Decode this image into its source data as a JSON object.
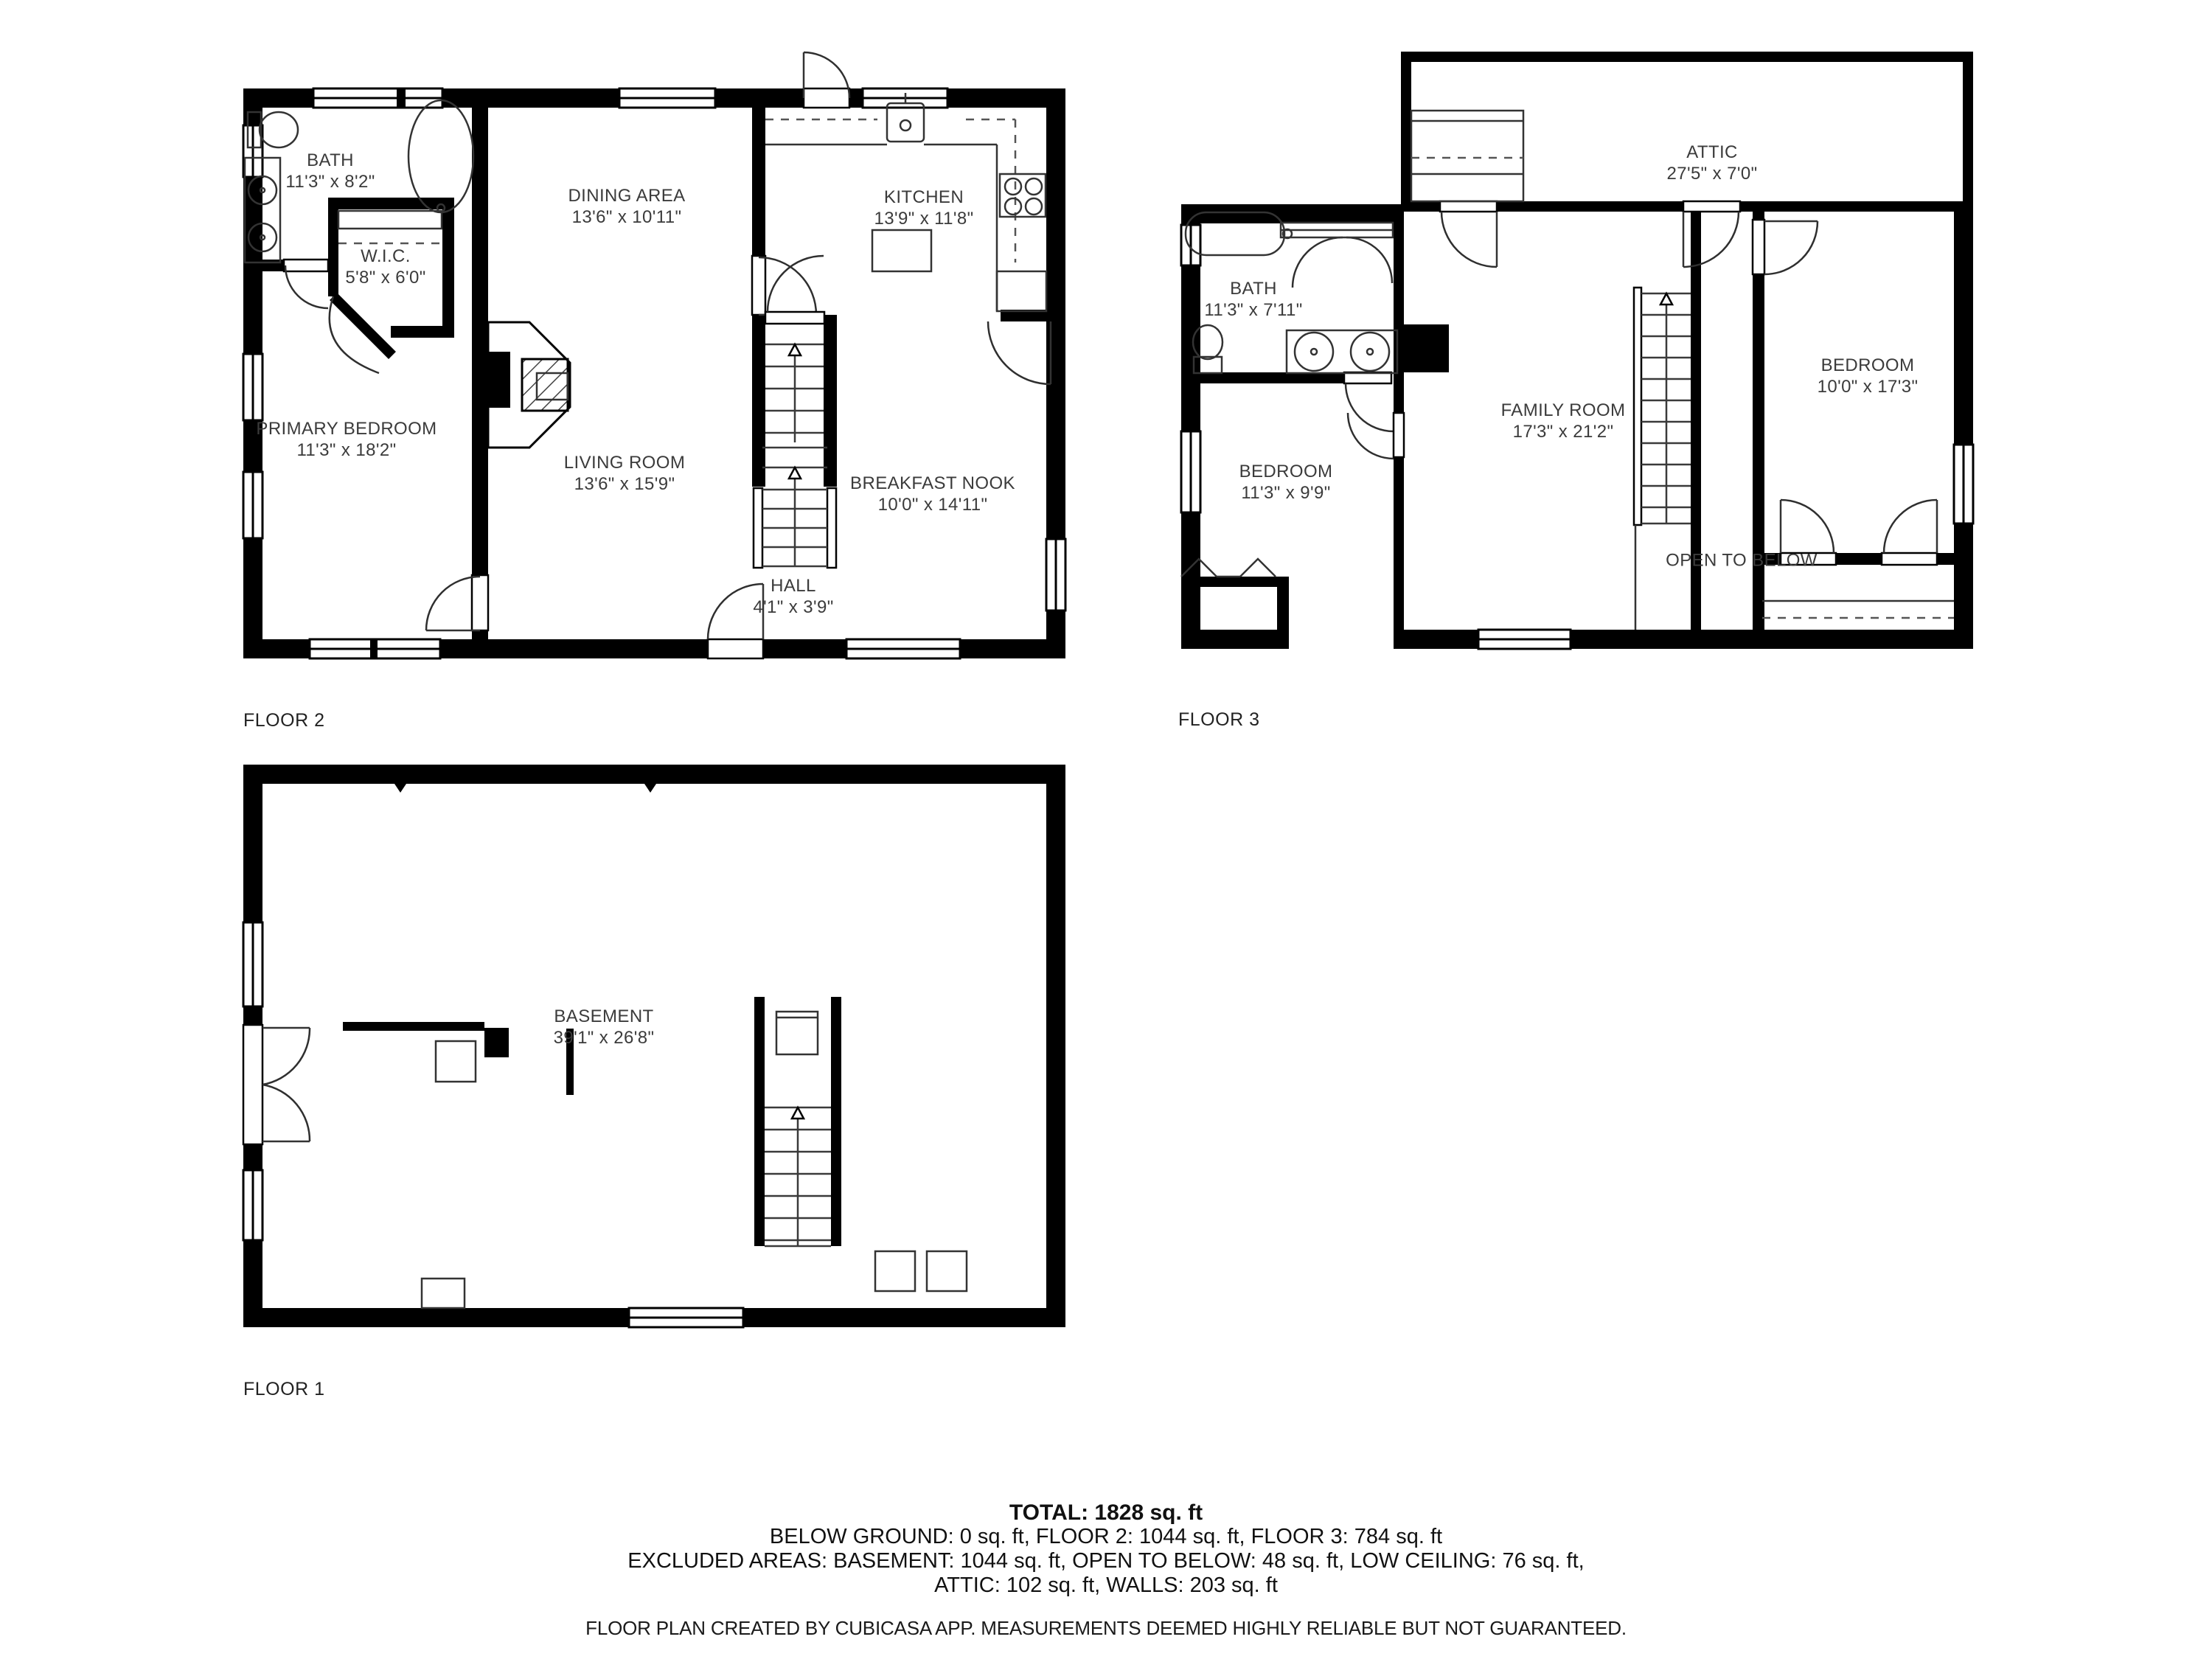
{
  "page": {
    "background": "#ffffff",
    "wall_color": "#000000",
    "label_color": "#3b3b3b"
  },
  "floors": [
    {
      "id": "floor2",
      "label": "FLOOR 2",
      "rooms": [
        {
          "name": "BATH",
          "dims": "11'3\" x 8'2\""
        },
        {
          "name": "W.I.C.",
          "dims": "5'8\" x 6'0\""
        },
        {
          "name": "DINING AREA",
          "dims": "13'6\" x 10'11\""
        },
        {
          "name": "KITCHEN",
          "dims": "13'9\" x 11'8\""
        },
        {
          "name": "PRIMARY BEDROOM",
          "dims": "11'3\" x 18'2\""
        },
        {
          "name": "LIVING ROOM",
          "dims": "13'6\" x 15'9\""
        },
        {
          "name": "BREAKFAST NOOK",
          "dims": "10'0\" x 14'11\""
        },
        {
          "name": "HALL",
          "dims": "4'1\" x 3'9\""
        }
      ]
    },
    {
      "id": "floor3",
      "label": "FLOOR 3",
      "rooms": [
        {
          "name": "ATTIC",
          "dims": "27'5\" x 7'0\""
        },
        {
          "name": "BATH",
          "dims": "11'3\" x 7'11\""
        },
        {
          "name": "BEDROOM",
          "dims": "11'3\" x 9'9\""
        },
        {
          "name": "FAMILY ROOM",
          "dims": "17'3\" x 21'2\""
        },
        {
          "name": "BEDROOM",
          "dims": "10'0\" x 17'3\""
        },
        {
          "name": "OPEN TO BELOW",
          "dims": ""
        }
      ]
    },
    {
      "id": "floor1",
      "label": "FLOOR 1",
      "rooms": [
        {
          "name": "BASEMENT",
          "dims": "39'1\" x 26'8\""
        }
      ]
    }
  ],
  "summary": {
    "total": "TOTAL: 1828 sq. ft",
    "line2": "BELOW GROUND: 0 sq. ft, FLOOR 2: 1044 sq. ft, FLOOR 3: 784 sq. ft",
    "line3": "EXCLUDED AREAS: BASEMENT: 1044 sq. ft, OPEN TO BELOW: 48 sq. ft, LOW CEILING: 76 sq. ft,",
    "line4": "ATTIC: 102 sq. ft, WALLS: 203 sq. ft"
  },
  "footer": "FLOOR PLAN CREATED BY CUBICASA APP. MEASUREMENTS DEEMED HIGHLY RELIABLE BUT NOT GUARANTEED."
}
